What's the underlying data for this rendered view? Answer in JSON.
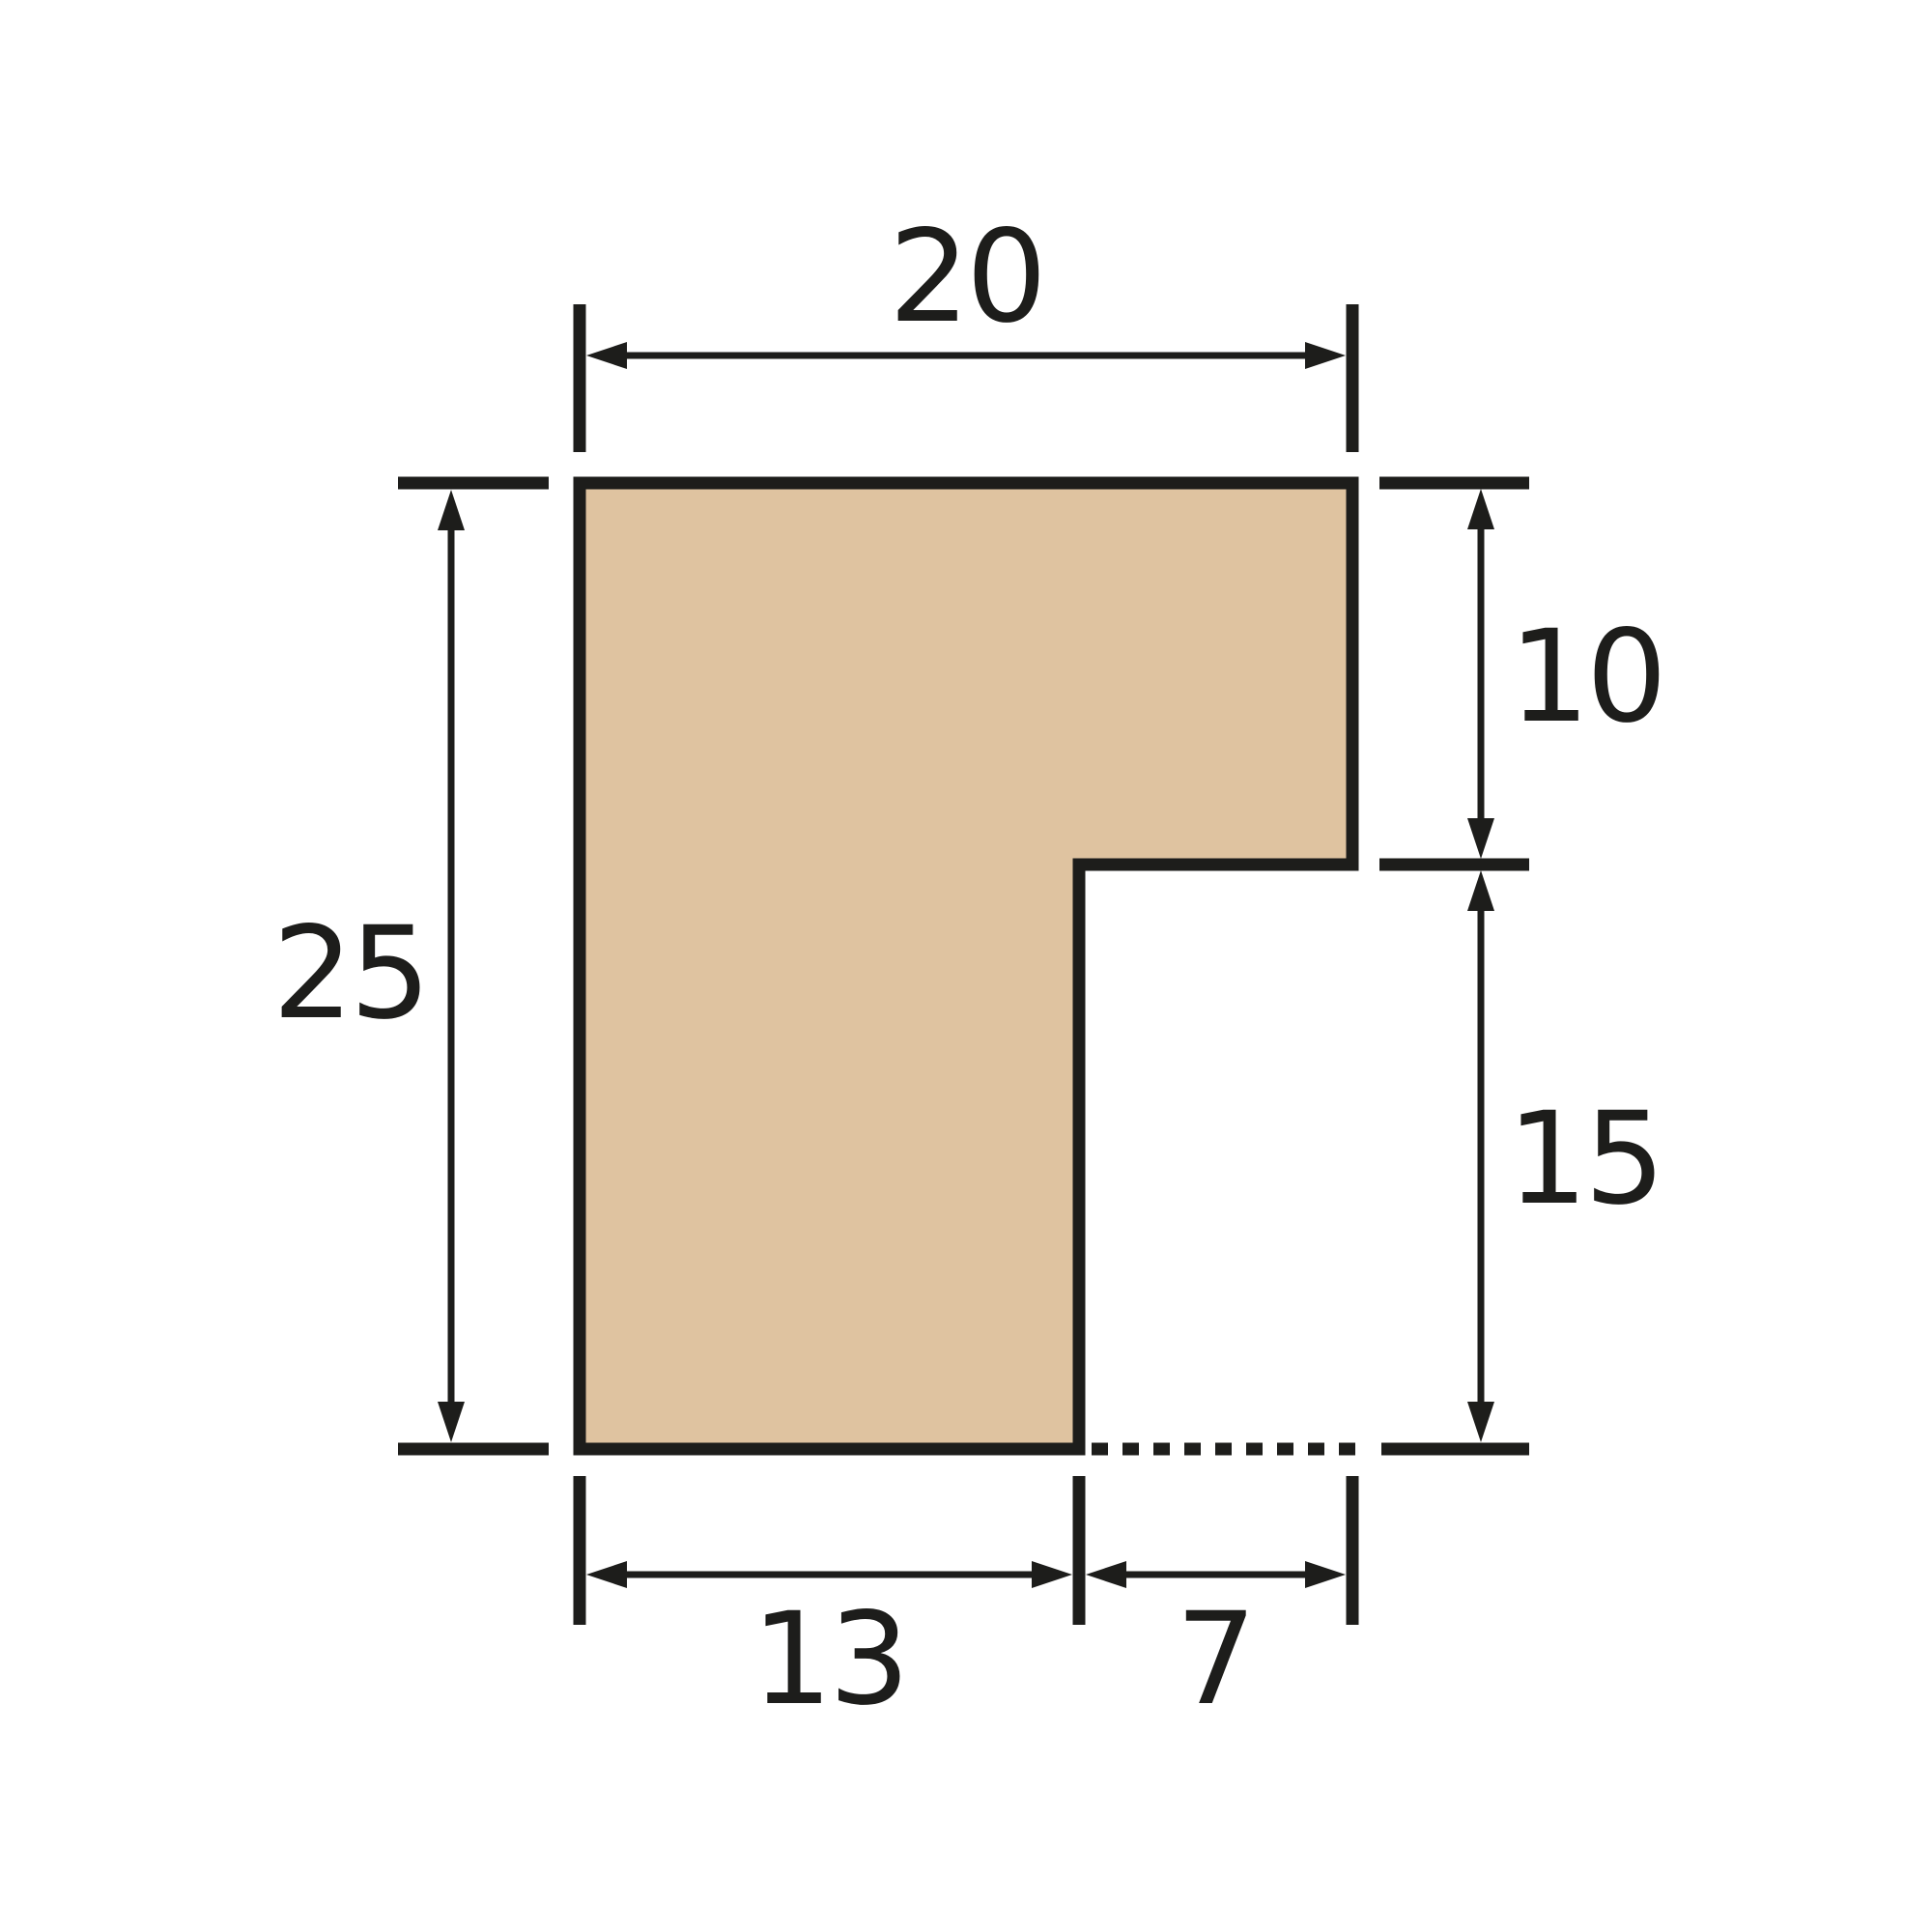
{
  "colors": {
    "background": "#ffffff",
    "line_color": "#1d1d1b",
    "shape_fill": "#dfc3a0"
  },
  "dimensions": {
    "top_width": "20",
    "left_height": "25",
    "right_upper": "10",
    "right_lower": "15",
    "bottom_left": "13",
    "bottom_right": "7"
  }
}
